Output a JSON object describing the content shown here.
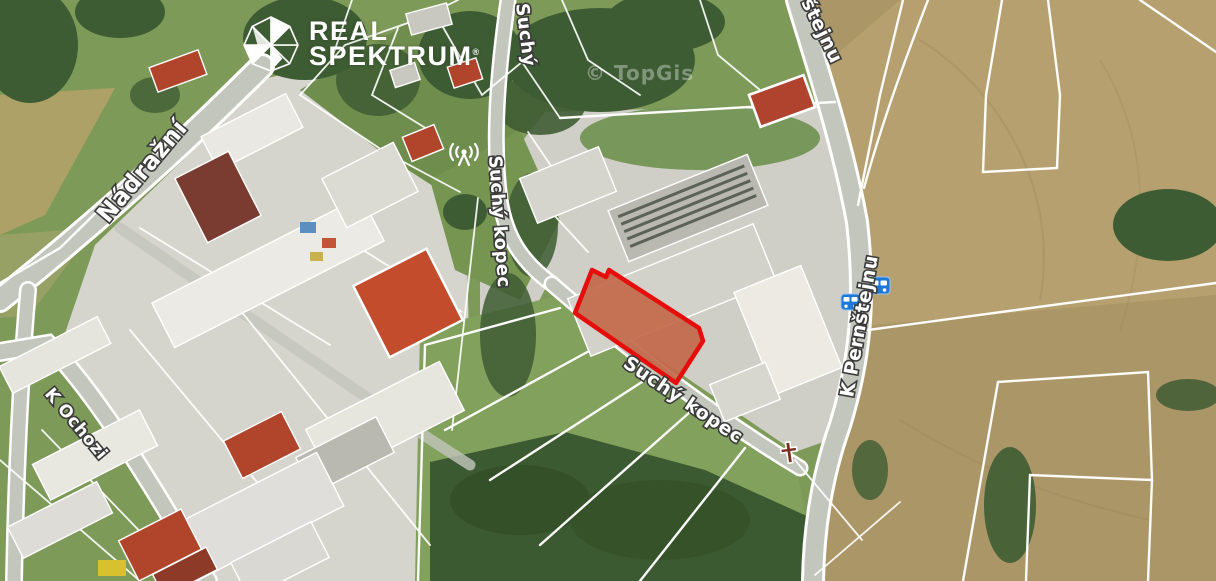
{
  "logo": {
    "line1": "REAL",
    "line2": "SPEKTRUM",
    "registered": "®",
    "icon": "realspektrum-faceted-gem-icon"
  },
  "map": {
    "provider_watermark": "© TopGis",
    "streets": {
      "nadrazni": "Nádražní",
      "suchy_partial": "Suchý",
      "suchy_kopec": "Suchý kopec",
      "k_pernstejnu": "K Pernštejnu",
      "k_pernstejnu_partial": "štejnu",
      "k_ochozi": "K Ochozi"
    },
    "icons": [
      "bus-stop-icon",
      "bus-stop-icon",
      "antenna-icon",
      "wayside-cross-icon"
    ],
    "highlight_parcel": {
      "stroke_color": "#e60d0d",
      "fill_color": "#c2684a",
      "description": "highlighted land parcel"
    },
    "palette": {
      "field_tan": "#ab9668",
      "grass_green": "#7e9a58",
      "forest_green": "#3c5a31",
      "concrete": "#d6d5cd",
      "court_orange": "#c34c2c",
      "bus_icon_blue": "#1e78d7"
    }
  }
}
